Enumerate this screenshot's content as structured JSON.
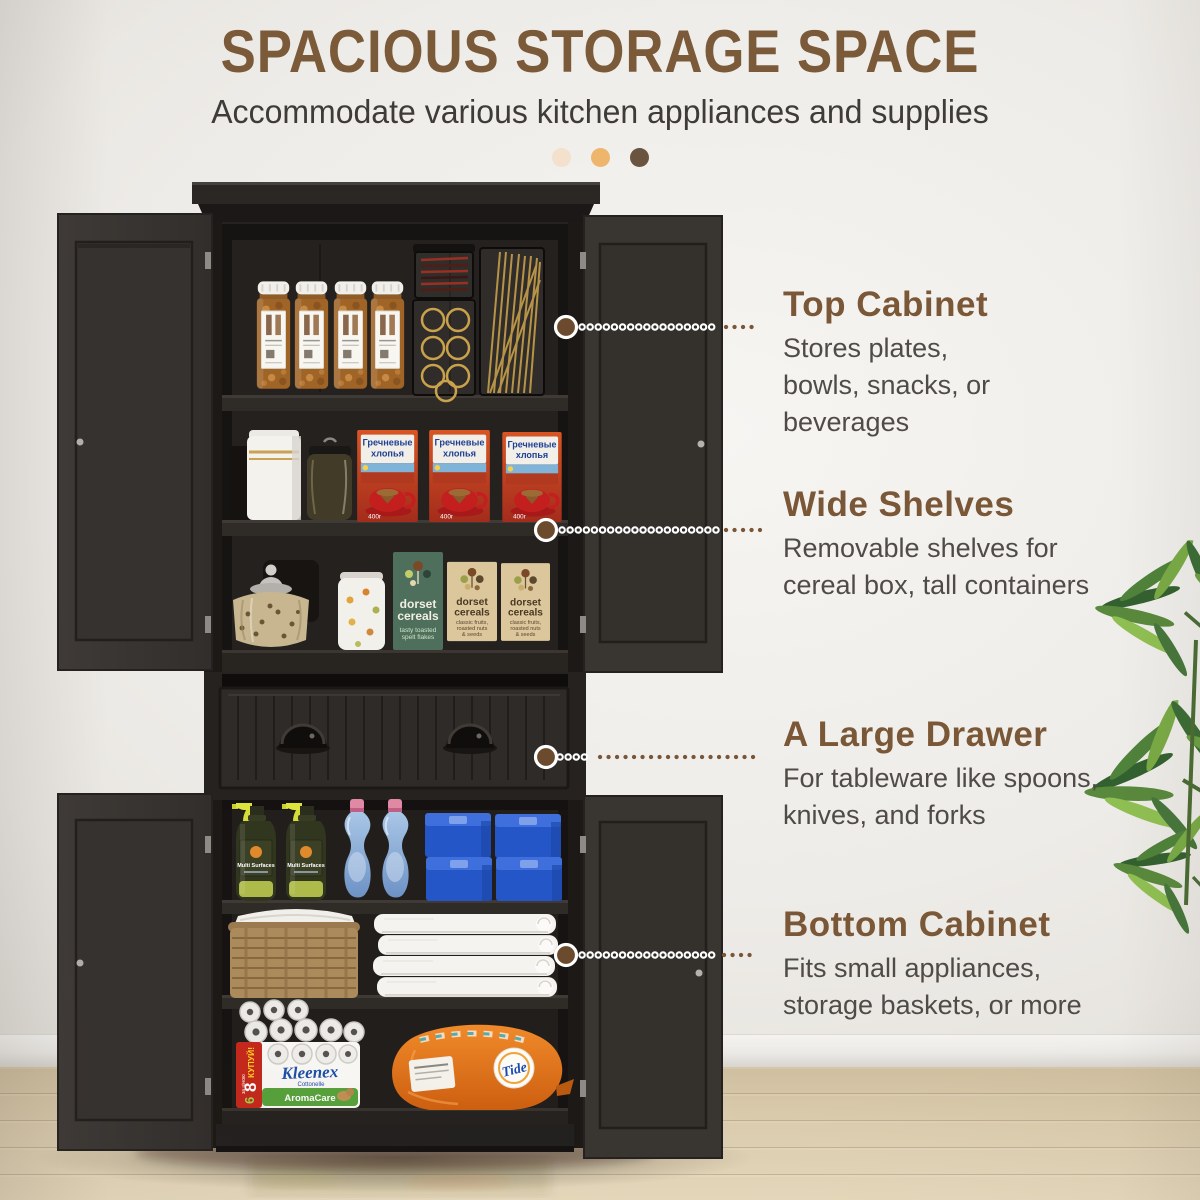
{
  "page": {
    "title": "SPACIOUS STORAGE SPACE",
    "subtitle": "Accommodate various kitchen appliances and supplies"
  },
  "accent_dots": [
    "#f3e0cd",
    "#eeb56d",
    "#6a5440"
  ],
  "callouts": [
    {
      "title": "Top Cabinet",
      "desc": "Stores plates,\nbowls, snacks, or beverages"
    },
    {
      "title": "Wide Shelves",
      "desc": "Removable shelves for\ncereal box, tall containers"
    },
    {
      "title": "A Large Drawer",
      "desc": "For tableware like spoons,\nknives, and forks"
    },
    {
      "title": "Bottom Cabinet",
      "desc": "Fits small appliances,\nstorage baskets, or more"
    }
  ],
  "products": {
    "cereal_box": {
      "line1": "Гречневые",
      "line2": "хлопья",
      "weight": "400г"
    },
    "dorset_green": {
      "brand1": "dorset",
      "brand2": "cereals",
      "desc1": "tasty toasted",
      "desc2": "spelt flakes"
    },
    "dorset_tan": {
      "brand1": "dorset",
      "brand2": "cereals",
      "desc1": "classic fruits,",
      "desc2": "roasted nuts",
      "desc3": "& seeds"
    },
    "spray": {
      "label": "Multi Surfaces"
    },
    "kleenex": {
      "brand": "Kleenex",
      "sub": "Cottonelle",
      "line": "AromaCare",
      "promo_top": "КУПУЙ!",
      "promo_count": "8",
      "promo_mid": "за ціною",
      "promo_num": "6"
    },
    "tide": {
      "brand": "Tide"
    }
  },
  "colors": {
    "title_brown": "#7b5a39",
    "heading_brown": "#7a5737",
    "body_text": "#4f4b47",
    "cabinet_black": "#2b2724",
    "door_gray": "#3a3633",
    "wall": "#eeece8",
    "floor_wood": "#dccdaf",
    "connector_brown": "#7a5636"
  }
}
